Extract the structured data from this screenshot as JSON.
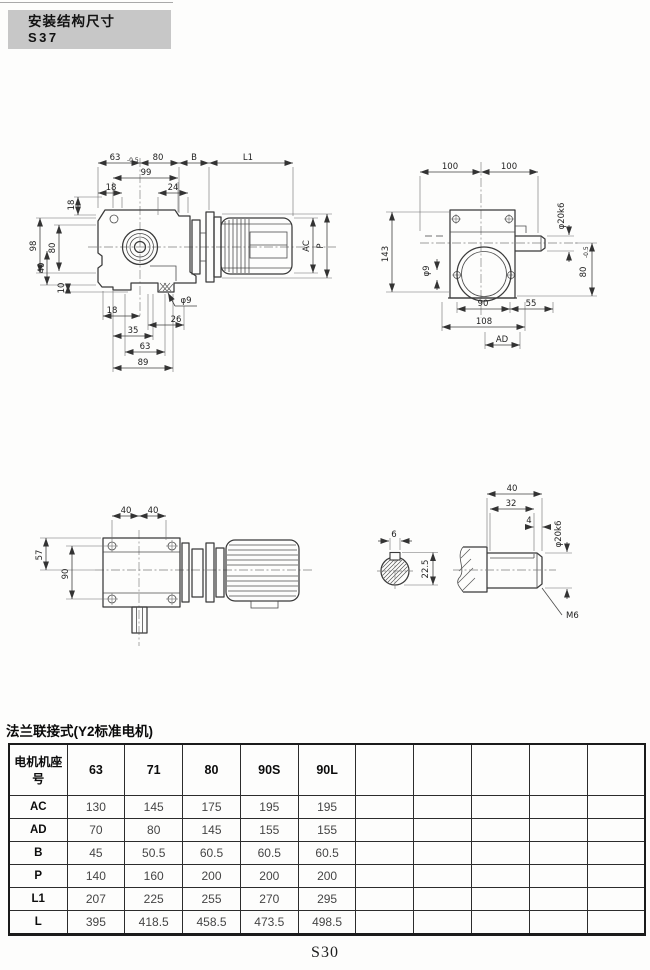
{
  "header": {
    "line1": "安装结构尺寸",
    "line2": "S37"
  },
  "footer": {
    "page_number": "S30"
  },
  "table": {
    "title": "法兰联接式(Y2标准电机)",
    "header_label": "电机机座号",
    "columns": [
      "63",
      "71",
      "80",
      "90S",
      "90L",
      "",
      "",
      "",
      "",
      ""
    ],
    "rows": [
      {
        "label": "AC",
        "values": [
          "130",
          "145",
          "175",
          "195",
          "195",
          "",
          "",
          "",
          "",
          ""
        ]
      },
      {
        "label": "AD",
        "values": [
          "70",
          "80",
          "145",
          "155",
          "155",
          "",
          "",
          "",
          "",
          ""
        ]
      },
      {
        "label": "B",
        "values": [
          "45",
          "50.5",
          "60.5",
          "60.5",
          "60.5",
          "",
          "",
          "",
          "",
          ""
        ]
      },
      {
        "label": "P",
        "values": [
          "140",
          "160",
          "200",
          "200",
          "200",
          "",
          "",
          "",
          "",
          ""
        ]
      },
      {
        "label": "L1",
        "values": [
          "207",
          "225",
          "255",
          "270",
          "295",
          "",
          "",
          "",
          "",
          ""
        ]
      },
      {
        "label": "L",
        "values": [
          "395",
          "418.5",
          "458.5",
          "473.5",
          "498.5",
          "",
          "",
          "",
          "",
          ""
        ]
      }
    ]
  },
  "drawings": {
    "front_view": {
      "dims": {
        "w63": "63",
        "w63_tol": "-0.5",
        "w80": "80",
        "wB": "B",
        "wL1": "L1",
        "w99": "99",
        "w18": "18",
        "w24": "24",
        "h18": "18",
        "h98": "98",
        "h80": "80",
        "h40": "40",
        "h10": "10",
        "hAC": "AC",
        "hP": "P",
        "phi9": "φ9",
        "b18": "18",
        "b26": "26",
        "b35": "35",
        "b63": "63",
        "b89": "89"
      }
    },
    "side_view": {
      "dims": {
        "t100a": "100",
        "t100b": "100",
        "h143": "143",
        "phi20": "φ20k6",
        "h80": "80",
        "h80_tol": "-0.5",
        "phi9": "φ9",
        "b90": "90",
        "b55": "55",
        "b108": "108",
        "bAD": "AD"
      }
    },
    "top_view": {
      "dims": {
        "t40a": "40",
        "t40b": "40",
        "h57": "57",
        "h90": "90"
      }
    },
    "shaft_detail": {
      "dims": {
        "key_w": "6",
        "sec": "22.5",
        "len40": "40",
        "len32": "32",
        "len4": "4",
        "phi20": "φ20k6",
        "m6": "M6"
      }
    }
  }
}
